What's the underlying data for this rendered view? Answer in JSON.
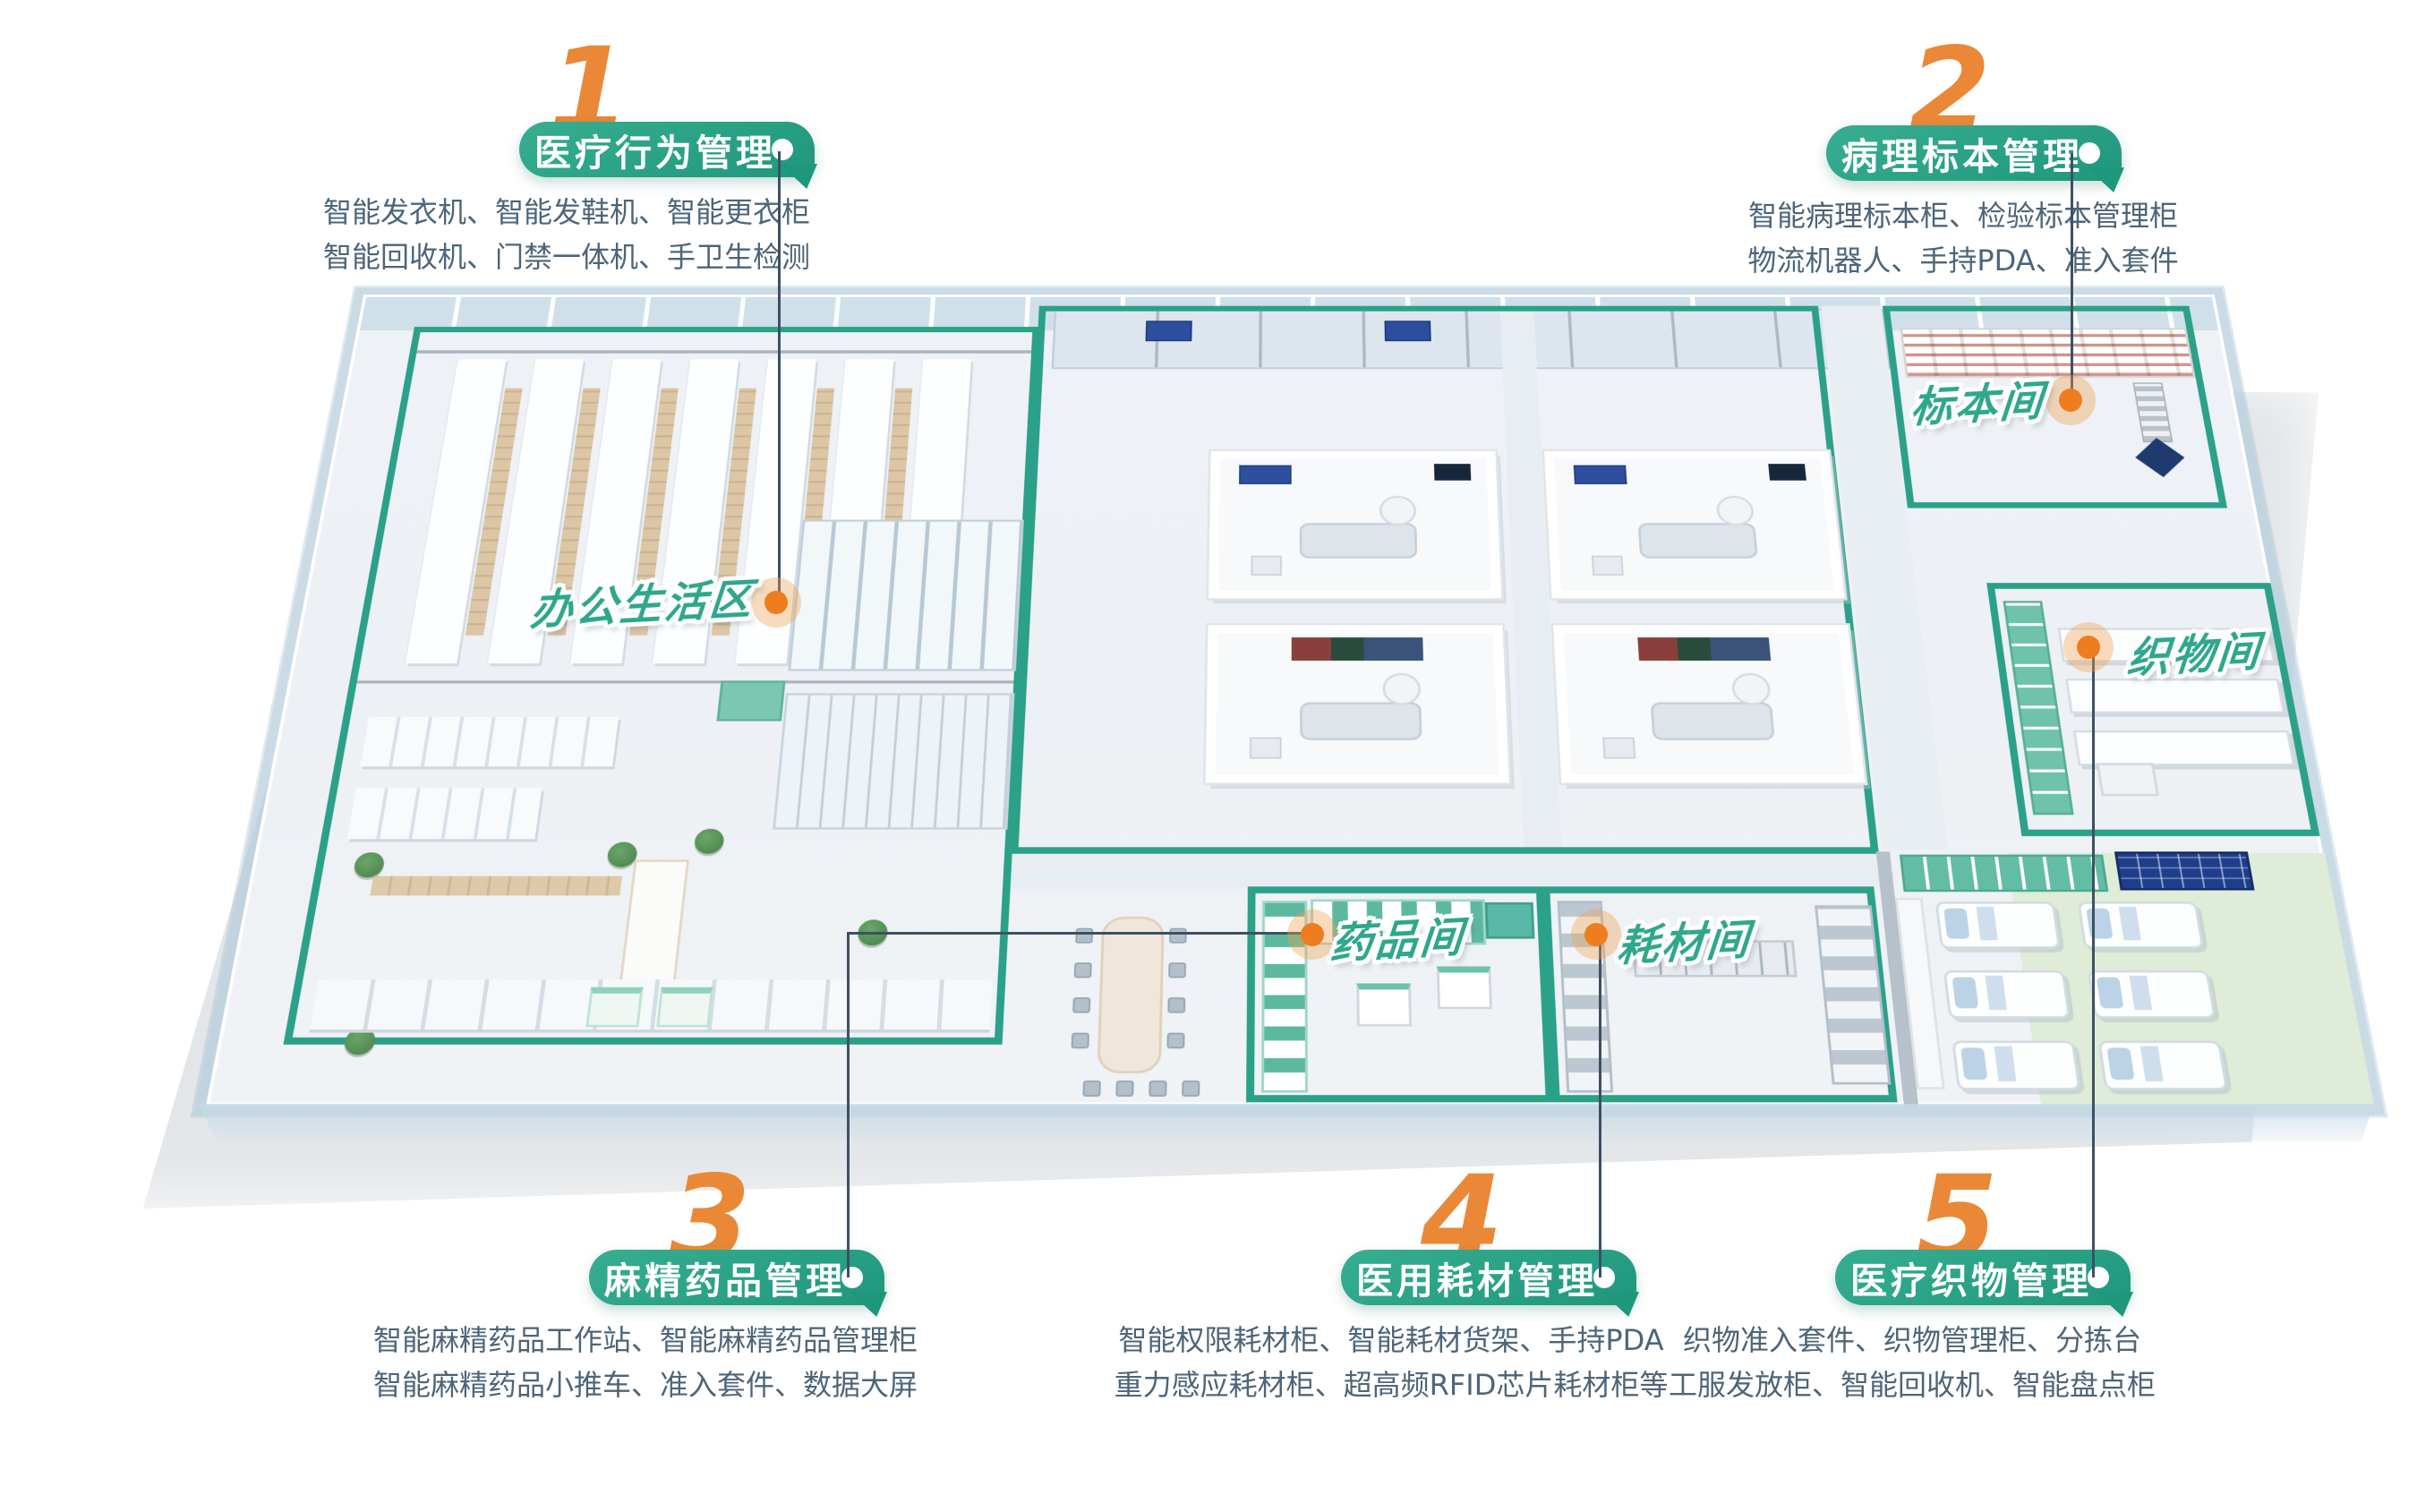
{
  "callouts": [
    {
      "number": "1",
      "title": "医疗行为管理",
      "desc1": "智能发衣机、智能发鞋机、智能更衣柜",
      "desc2": "智能回收机、门禁一体机、手卫生检测"
    },
    {
      "number": "2",
      "title": "病理标本管理",
      "desc1": "智能病理标本柜、检验标本管理柜",
      "desc2": "物流机器人、手持PDA、准入套件"
    },
    {
      "number": "3",
      "title": "麻精药品管理",
      "desc1": "智能麻精药品工作站、智能麻精药品管理柜",
      "desc2": "智能麻精药品小推车、准入套件、数据大屏"
    },
    {
      "number": "4",
      "title": "医用耗材管理",
      "desc1": "智能权限耗材柜、智能耗材货架、手持PDA",
      "desc2": "重力感应耗材柜、超高频RFID芯片耗材柜等"
    },
    {
      "number": "5",
      "title": "医疗织物管理",
      "desc1": "织物准入套件、织物管理柜、分拣台",
      "desc2": "工服发放柜、智能回收机、智能盘点柜"
    }
  ],
  "rooms": [
    {
      "label": "办公生活区"
    },
    {
      "label": "标本间"
    },
    {
      "label": "织物间"
    },
    {
      "label": "药品间"
    },
    {
      "label": "耗材间"
    }
  ],
  "colors": {
    "zone_green": "#2aa188",
    "pill_green": "#249a80",
    "number_orange": "#ea8838",
    "marker_orange": "#ed7d1f",
    "desc_text": "#4d6579",
    "room_label_green": "#2fa78c",
    "connector": "#3e5065"
  }
}
